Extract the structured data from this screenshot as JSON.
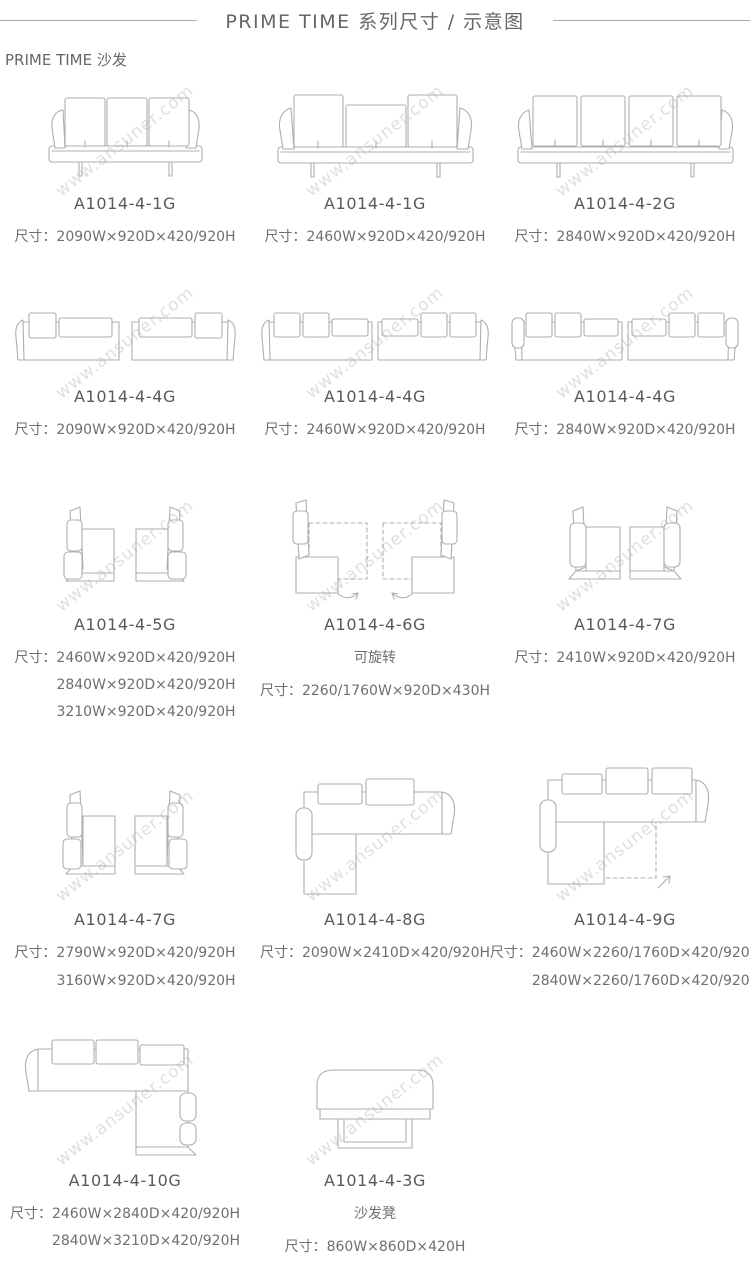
{
  "header": {
    "title": "PRIME TIME 系列尺寸 / 示意图",
    "subtitle": "PRIME TIME 沙发"
  },
  "watermark": "www.ansuner.com",
  "colors": {
    "title_text": "#666666",
    "model_text": "#595959",
    "dims_text": "#6f6f6f",
    "line_art": "#aab0b0",
    "rule": "#a9a9a9",
    "watermark": "#b9b0a6"
  },
  "items": [
    {
      "id": "A1014-4-1G",
      "dims": [
        "尺寸：2090W×920D×420/920H"
      ],
      "diagram": "three-seater-sofa-front-view"
    },
    {
      "id": "A1014-4-1G",
      "dims": [
        "尺寸：2460W×920D×420/920H"
      ],
      "diagram": "three-seater-wide-sofa-front-view"
    },
    {
      "id": "A1014-4-2G",
      "dims": [
        "尺寸：2840W×920D×420/920H"
      ],
      "diagram": "four-seater-sofa-front-view"
    },
    {
      "id": "A1014-4-4G",
      "dims": [
        "尺寸：2090W×920D×420/920H"
      ],
      "diagram": "two-module-sofa-pair"
    },
    {
      "id": "A1014-4-4G",
      "dims": [
        "尺寸：2460W×920D×420/920H"
      ],
      "diagram": "two-module-sofa-pair"
    },
    {
      "id": "A1014-4-4G",
      "dims": [
        "尺寸：2840W×920D×420/920H"
      ],
      "diagram": "two-module-sofa-pair"
    },
    {
      "id": "A1014-4-5G",
      "dims": [
        "尺寸：2460W×920D×420/920H",
        "2840W×920D×420/920H",
        "3210W×920D×420/920H"
      ],
      "diagram": "facing-end-units-side-view"
    },
    {
      "id": "A1014-4-6G",
      "note": "可旋转",
      "dims": [
        "尺寸：2260/1760W×920D×430H"
      ],
      "diagram": "rotatable-end-units-with-dashed-positions"
    },
    {
      "id": "A1014-4-7G",
      "dims": [
        "尺寸：2410W×920D×420/920H"
      ],
      "diagram": "facing-end-units-side-view"
    },
    {
      "id": "A1014-4-7G",
      "dims": [
        "尺寸：2790W×920D×420/920H",
        "3160W×920D×420/920H"
      ],
      "diagram": "facing-end-units-side-view"
    },
    {
      "id": "A1014-4-8G",
      "dims": [
        "尺寸：2090W×2410D×420/920H"
      ],
      "diagram": "l-shaped-corner-sofa-top-view"
    },
    {
      "id": "A1014-4-9G",
      "dims": [
        "尺寸：2460W×2260/1760D×420/920H",
        "2840W×2260/1760D×420/920H"
      ],
      "diagram": "l-shaped-corner-sofa-rotatable-top-view"
    },
    {
      "id": "A1014-4-10G",
      "dims": [
        "尺寸：2460W×2840D×420/920H",
        "2840W×3210D×420/920H"
      ],
      "diagram": "l-shaped-corner-sofa-mirrored-top-view"
    },
    {
      "id": "A1014-4-3G",
      "note": "沙发凳",
      "dims": [
        "尺寸：860W×860D×420H"
      ],
      "diagram": "ottoman-front-view"
    }
  ]
}
